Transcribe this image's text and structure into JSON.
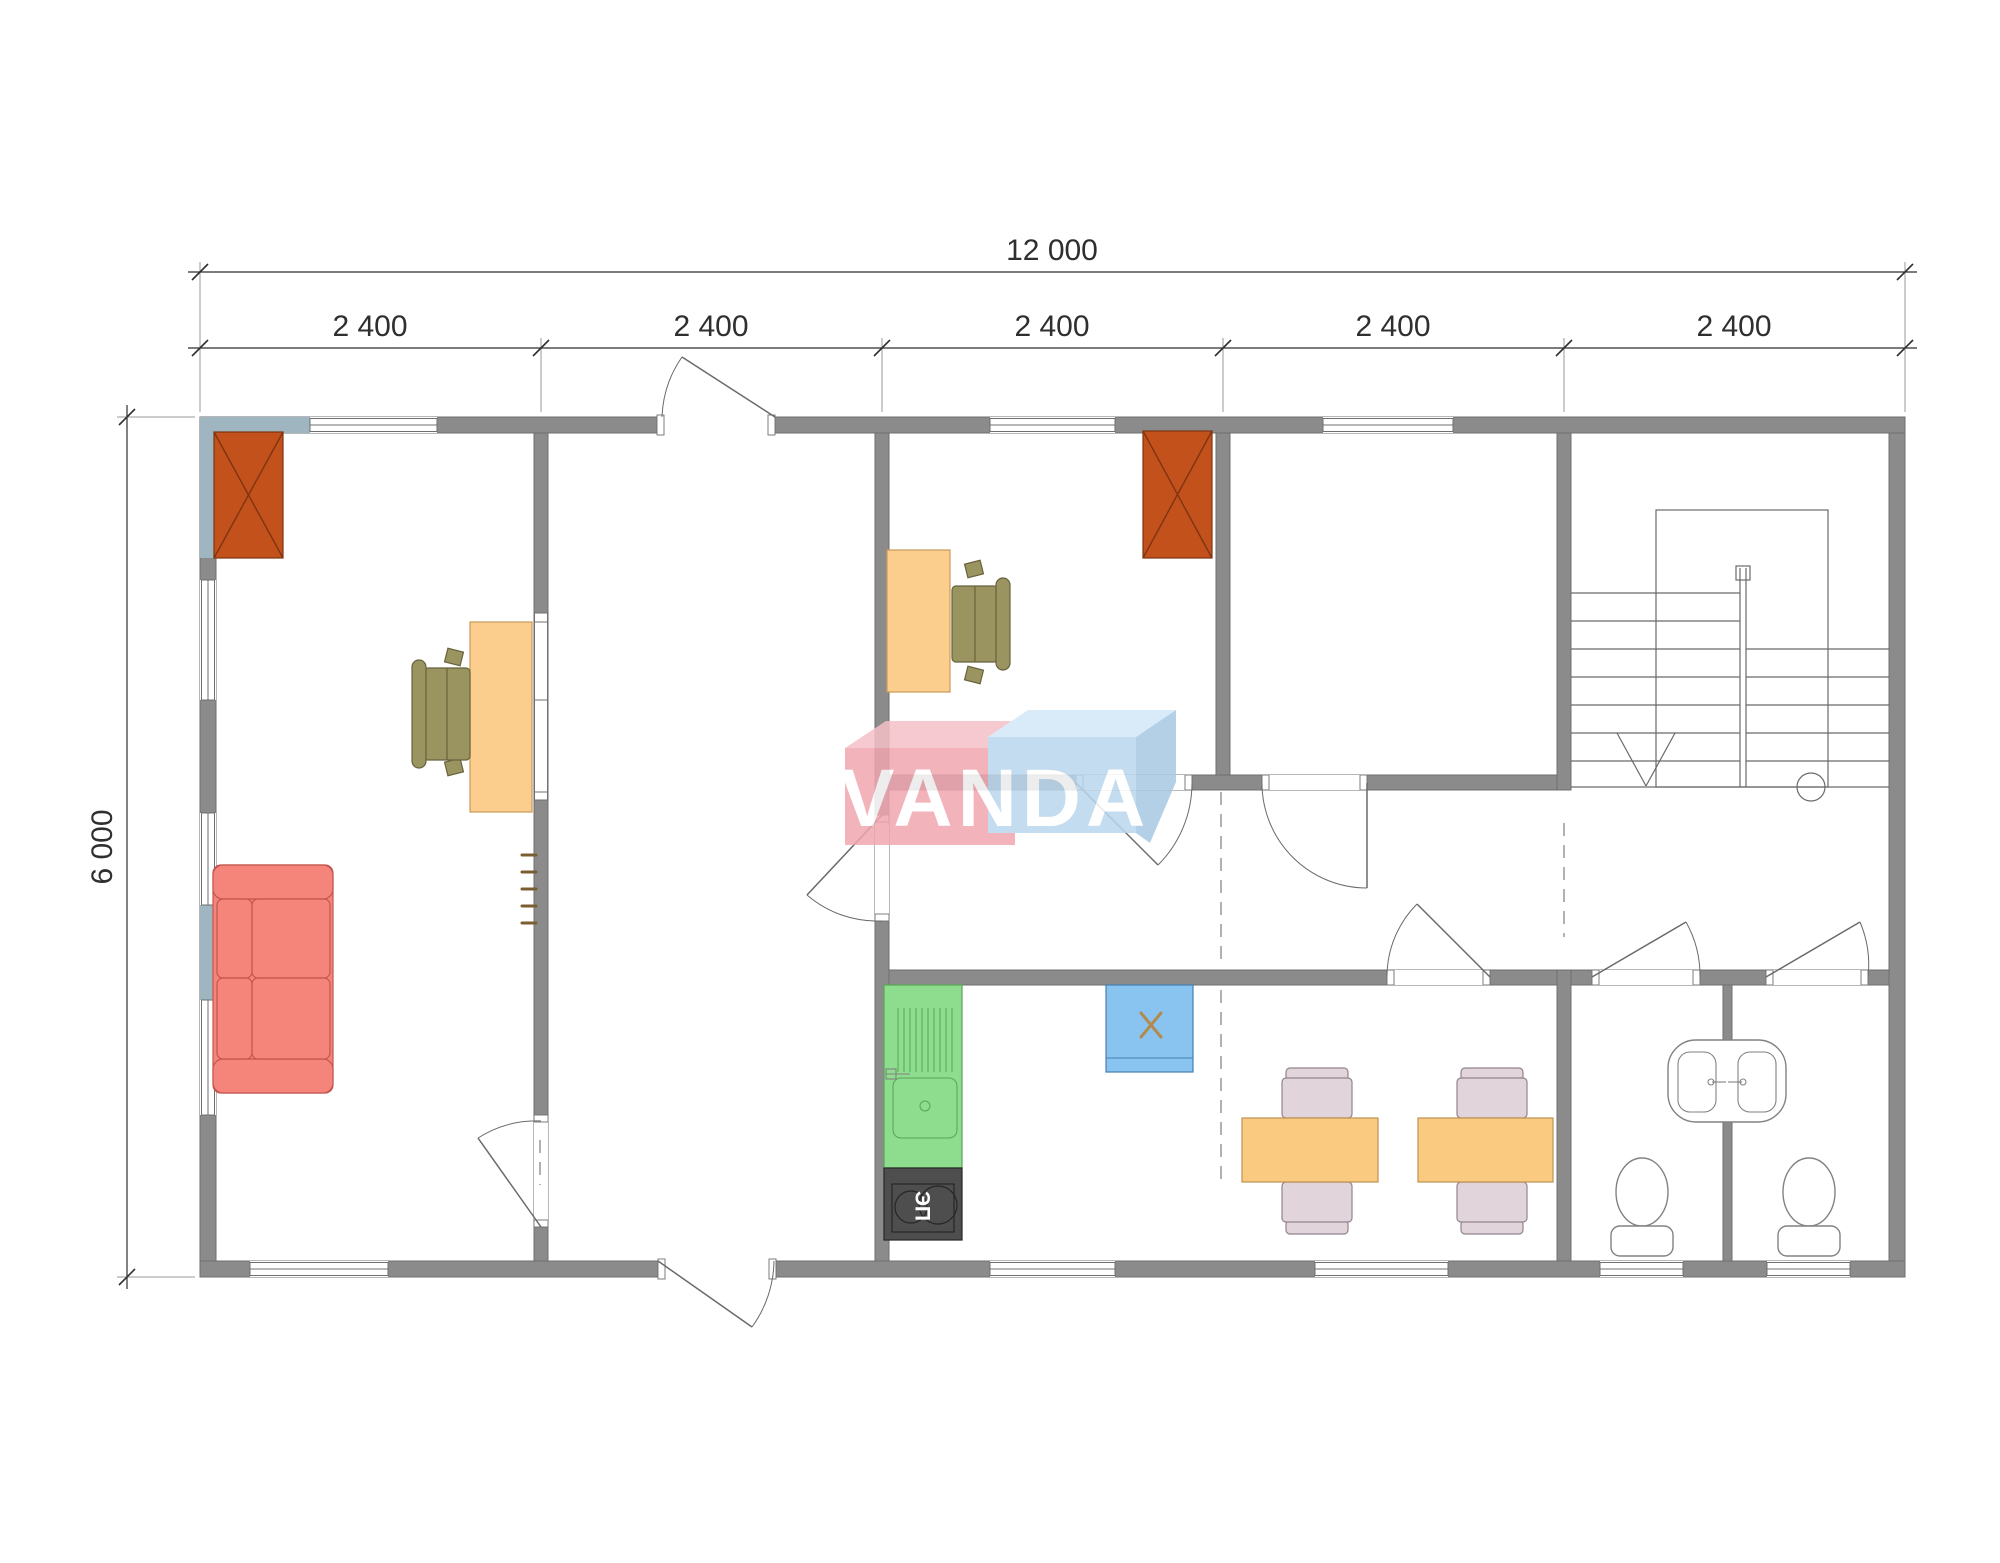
{
  "document": {
    "type": "architectural-floor-plan",
    "units": "mm"
  },
  "watermark": {
    "brand": "VANDA"
  },
  "dimensions": {
    "total_width_label": "12 000",
    "height_label": "6 000",
    "segment_labels": [
      "2 400",
      "2 400",
      "2 400",
      "2 400",
      "2 400"
    ]
  },
  "labels": {
    "stove": "ЭП"
  },
  "inventory": {
    "rooms": [
      "office-left",
      "entrance-hall",
      "office-middle",
      "office-right",
      "stair-room",
      "corridor",
      "kitchen-dining",
      "wc-left",
      "wc-right"
    ],
    "furniture": [
      "wardrobe-box",
      "sofa",
      "desk-with-chair",
      "desk-with-chair",
      "wardrobe-box",
      "coat-hooks",
      "kitchen-sink-unit",
      "electric-stove",
      "appliance-box",
      "dining-table-with-chairs",
      "dining-table-with-chairs",
      "twin-washbasins",
      "toilet",
      "toilet",
      "staircase-down"
    ]
  },
  "colors": {
    "wall": "#8B8B8B",
    "wall_edge": "#6F6F6F",
    "line": "#6A6A6A",
    "dim": "#2F2F2F",
    "dash": "#909090",
    "tint": "#9FB6C1",
    "redbox": "#C3511B",
    "redbox_line": "#7E3410",
    "sofa": "#F5857B",
    "sofa_line": "#C2564E",
    "desk": "#FBCE8E",
    "desk_line": "#C79A5B",
    "olive": "#9A9460",
    "olive_line": "#67623C",
    "table": "#FACA80",
    "table_line": "#BE9254",
    "pchair": "#E2D4DB",
    "pchair_line": "#93848D",
    "kitchen": "#8EDC8E",
    "kitchen_line": "#57A657",
    "stove": "#4E4E4E",
    "stove_line": "#262626",
    "appliance": "#89C4F1",
    "appliance_line": "#4380B0",
    "xmark": "#B28A4E",
    "hook": "#7A5E31",
    "fixture": "#828282",
    "logo_pink": "#F0A6B0",
    "logo_pink_top": "#F5C0C8",
    "logo_blue": "#BAD7ED",
    "logo_blue_top": "#D3E8F8",
    "logo_blue_side": "#A8C8E3",
    "logo_text": "#FFFFFF"
  }
}
